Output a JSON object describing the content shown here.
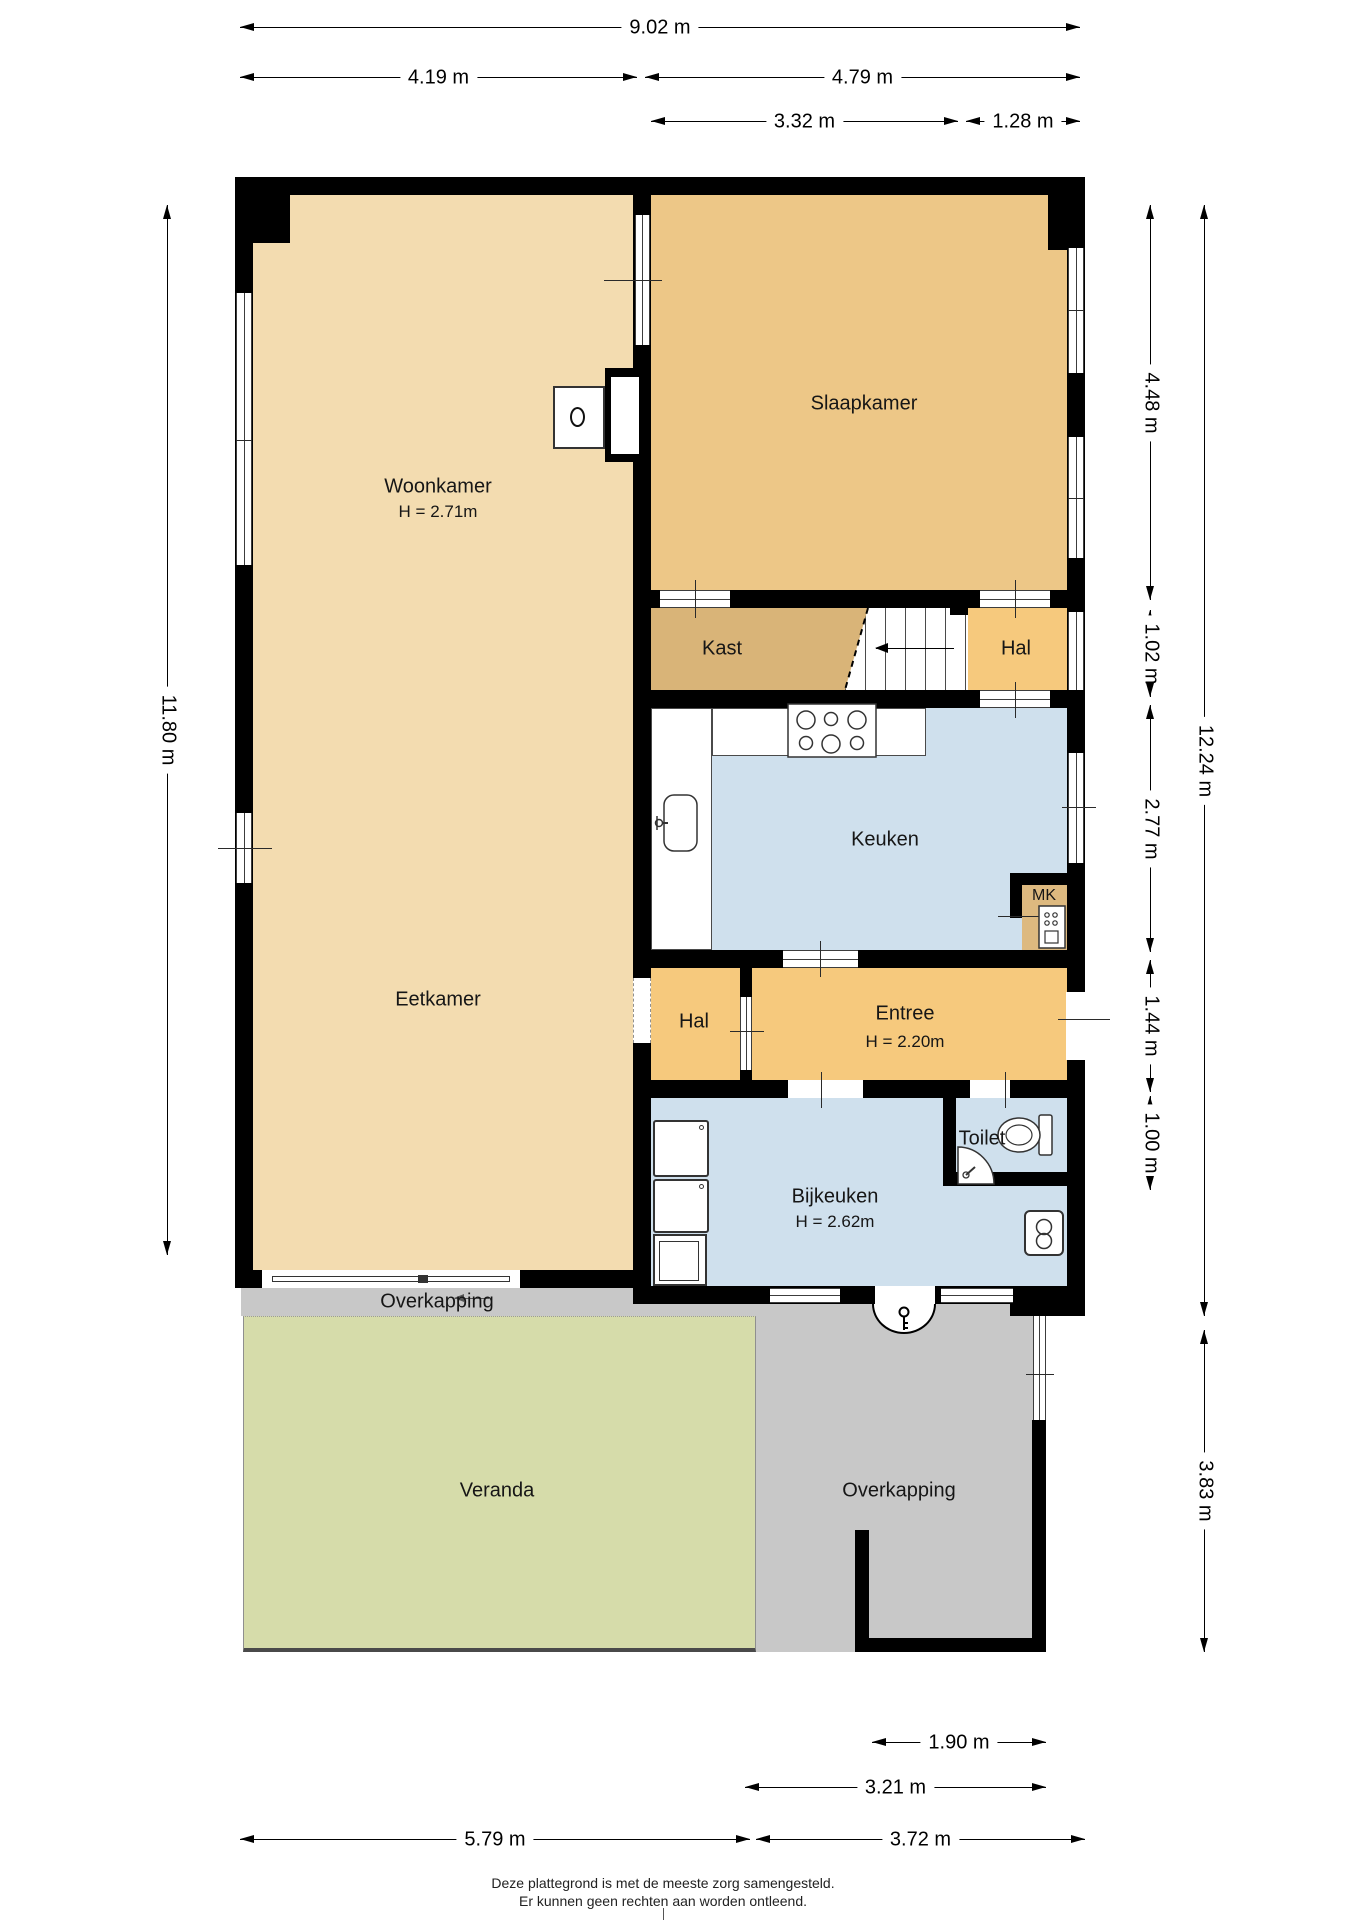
{
  "plan": {
    "rooms": {
      "woonkamer": {
        "label": "Woonkamer",
        "height": "H = 2.71m"
      },
      "slaapkamer": {
        "label": "Slaapkamer"
      },
      "kast": {
        "label": "Kast"
      },
      "hal_top": {
        "label": "Hal"
      },
      "keuken": {
        "label": "Keuken"
      },
      "mk": {
        "label": "MK"
      },
      "eetkamer": {
        "label": "Eetkamer"
      },
      "hal_bottom": {
        "label": "Hal"
      },
      "entree": {
        "label": "Entree",
        "height": "H = 2.20m"
      },
      "toilet": {
        "label": "Toilet"
      },
      "bijkeuken": {
        "label": "Bijkeuken",
        "height": "H = 2.62m"
      },
      "overkapping_top": {
        "label": "Overkapping"
      },
      "veranda": {
        "label": "Veranda"
      },
      "overkapping_right": {
        "label": "Overkapping"
      }
    },
    "colors": {
      "wall": "#000000",
      "living_tan": "#F3DCB0",
      "bedroom_tan": "#EDC787",
      "closet_brown": "#D9B478",
      "mk_brown": "#DDB97F",
      "hall_orange": "#F6C97D",
      "wet_blue": "#CFE0ED",
      "canopy_gray": "#C8C8C8",
      "veranda_green": "#D6DCAA"
    },
    "icons": {
      "stairs_direction": "arrow-left-icon",
      "sliding_door_direction": "arrow-left-icon",
      "back_door": "key-icon"
    }
  },
  "dimensions": {
    "top": {
      "full": "9.02 m",
      "left": "4.19 m",
      "right": "4.79 m",
      "inner_left": "3.32 m",
      "inner_right": "1.28 m"
    },
    "left": {
      "full": "11.80 m"
    },
    "right": {
      "slaapkamer": "4.48 m",
      "hal": "1.02 m",
      "keuken": "2.77 m",
      "entree": "1.44 m",
      "toilet": "1.00 m",
      "full": "12.24 m",
      "overkapping": "3.83 m"
    },
    "bottom": {
      "opening": "1.90 m",
      "overkapping": "3.21 m",
      "left": "5.79 m",
      "right": "3.72 m"
    }
  },
  "footer": {
    "line1": "Deze plattegrond is met de meeste zorg samengesteld.",
    "line2": "Er kunnen geen rechten aan worden ontleend."
  }
}
